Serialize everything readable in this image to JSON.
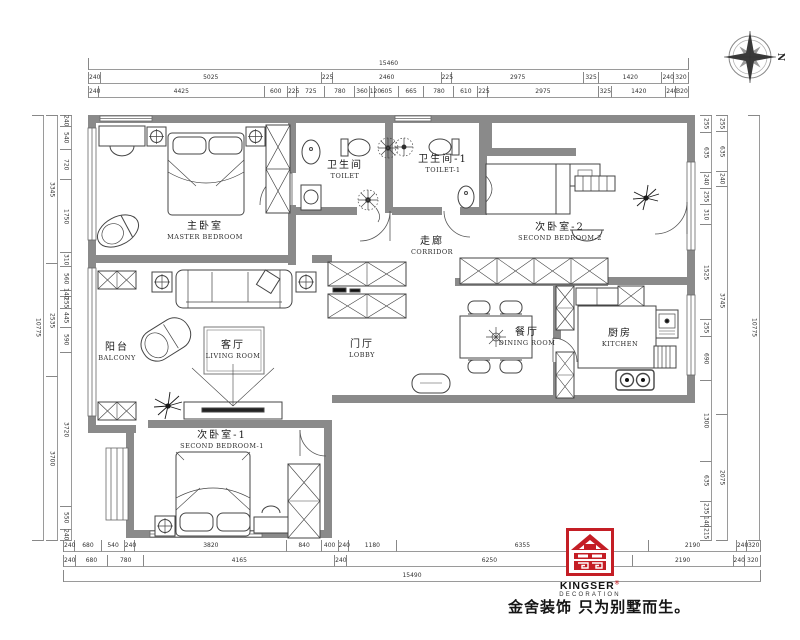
{
  "meta": {
    "compass_label": "N"
  },
  "rooms": {
    "master_bedroom": {
      "cn": "主卧室",
      "en": "MASTER BEDROOM"
    },
    "toilet": {
      "cn": "卫生间",
      "en": "TOILET"
    },
    "toilet_1": {
      "cn": "卫生间-1",
      "en": "TOILET-1"
    },
    "second_bedroom_2": {
      "cn": "次卧室-2",
      "en": "SECOND BEDROOM-2"
    },
    "corridor": {
      "cn": "走廊",
      "en": "CORRIDOR"
    },
    "balcony": {
      "cn": "阳台",
      "en": "BALCONY"
    },
    "living_room": {
      "cn": "客厅",
      "en": "LIVING ROOM"
    },
    "lobby": {
      "cn": "门厅",
      "en": "LOBBY"
    },
    "dining_room": {
      "cn": "餐厅",
      "en": "DINING ROOM"
    },
    "kitchen": {
      "cn": "厨房",
      "en": "KITCHEN"
    },
    "second_bedroom_1": {
      "cn": "次卧室-1",
      "en": "SECOND BEDROOM-1"
    }
  },
  "dimensions": {
    "top": {
      "overall": [
        "15460"
      ],
      "row2": [
        "240",
        "5025",
        "225",
        "2460",
        "225",
        "2975",
        "325",
        "1420",
        "240",
        "320"
      ],
      "row3": [
        "240",
        "4425",
        "600",
        "225",
        "725",
        "780",
        "360",
        "120",
        "605",
        "665",
        "780",
        "610",
        "225",
        "2975",
        "325",
        "1420",
        "240",
        "320"
      ]
    },
    "bottom": {
      "row1": [
        "240",
        "680",
        "540",
        "240",
        "3820",
        "840",
        "400",
        "240",
        "1180",
        "6355",
        "2190",
        "240",
        "320"
      ],
      "row2": [
        "240",
        "680",
        "780",
        "4165",
        "240",
        "6250",
        "2190",
        "240",
        "320"
      ],
      "overall": [
        "15490"
      ]
    },
    "left": {
      "outer": [
        "10775"
      ],
      "mid": [
        "3345",
        "2535",
        "3700"
      ],
      "inner": [
        "240",
        "540",
        "720",
        "1750",
        "310",
        "560",
        "140",
        "255",
        "445",
        "590",
        "3720",
        "550",
        "240"
      ]
    },
    "right": {
      "inner": [
        "255",
        "635",
        "240",
        "255",
        "310",
        "1525",
        "255",
        "690",
        "1300",
        "635",
        "235",
        "140",
        "215"
      ],
      "mid": [
        "255",
        "635",
        "240",
        "3745",
        "2075"
      ],
      "outer": [
        "10775"
      ]
    }
  },
  "branding": {
    "logo_line1": "KINGSER",
    "logo_reg": "®",
    "logo_line2": "DECORATION",
    "tagline": "金舍装饰 只为别墅而生。",
    "logo_color": "#c41e25"
  },
  "colors": {
    "wall": "#8a8a8a",
    "line": "#444444",
    "dim_text": "#333333"
  }
}
